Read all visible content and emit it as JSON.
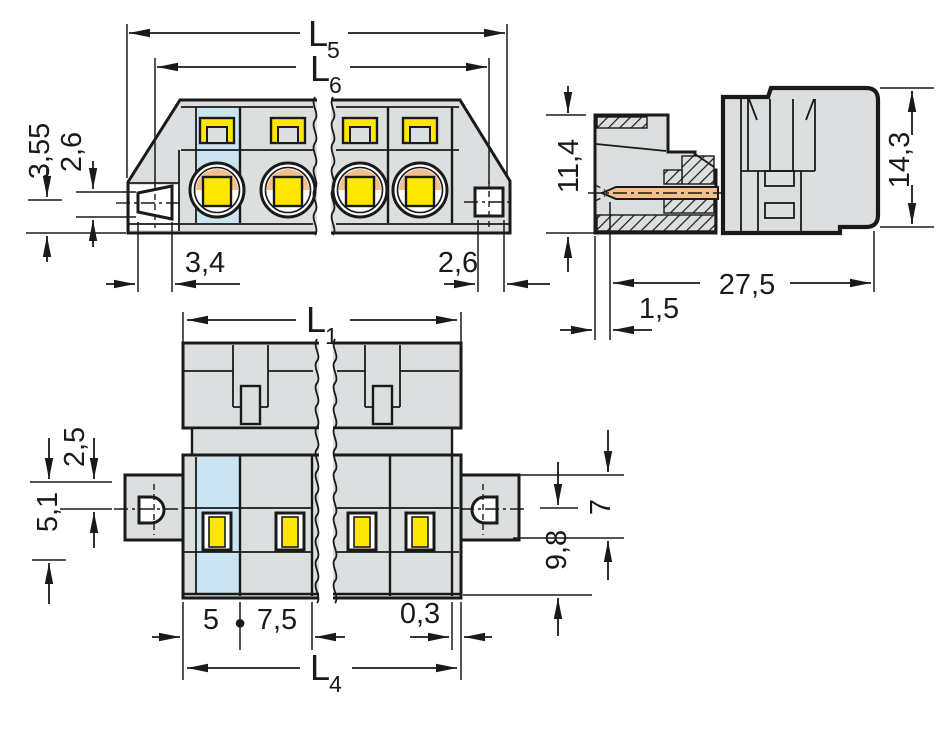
{
  "colors": {
    "line": "#1a1a1a",
    "body_gray": "#dcdfe0",
    "highlight_blue": "#cbe4f2",
    "clamp_yellow": "#ffe800",
    "contact_orange": "#f5be8a",
    "background": "#ffffff"
  },
  "views": {
    "front": {
      "l5": {
        "main": "L",
        "sub": "5"
      },
      "l6": {
        "main": "L",
        "sub": "6"
      },
      "h355": "3,55",
      "h26": "2,6",
      "w34": "3,4",
      "w26": "2,6"
    },
    "side": {
      "h114": "11,4",
      "h143": "14,3",
      "w275": "27,5",
      "w15": "1,5"
    },
    "plan": {
      "l1": {
        "main": "L",
        "sub": "1"
      },
      "l4": {
        "main": "L",
        "sub": "4"
      },
      "o25": "2,5",
      "o51": "5,1",
      "f7": "7",
      "d98": "9,8",
      "p5": "5",
      "sep": "●",
      "p75": "7,5",
      "g03": "0,3"
    }
  }
}
